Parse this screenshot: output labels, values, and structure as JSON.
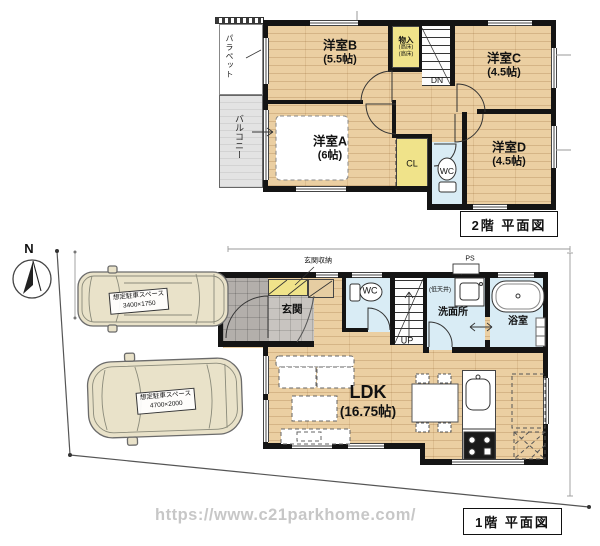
{
  "meta": {
    "watermark": "https://www.c21parkhome.com/"
  },
  "colors": {
    "wood_floor": "#ebcfa2",
    "wall": "#141414",
    "closet_yellow": "#f0e38a",
    "wet_area_blue": "#d9ecf5",
    "entrance_tile_gray": "#c8c4c0",
    "porch_gray": "#b3afab",
    "balcony_gray": "#e3e3e3",
    "car_body": "#e9e2c9"
  },
  "floor2": {
    "caption": "2階 平面図",
    "room_b": {
      "name": "洋室B",
      "size": "(5.5帖)"
    },
    "room_c": {
      "name": "洋室C",
      "size": "(4.5帖)"
    },
    "room_a": {
      "name": "洋室A",
      "size": "(6帖)"
    },
    "room_d": {
      "name": "洋室D",
      "size": "(4.5帖)"
    },
    "storage": {
      "name": "物入",
      "note1": "(高床)",
      "note2": "(高床)"
    },
    "closet": "CL",
    "toilet": "WC",
    "balcony": "バルコニー",
    "parapet": "パラペット",
    "stairs_down": "DN"
  },
  "floor1": {
    "caption": "1階 平面図",
    "ldk": {
      "name": "LDK",
      "size": "(16.75帖)"
    },
    "entrance": "玄関",
    "entrance_storage": "玄関収納",
    "toilet": "WC",
    "washroom": "洗面所",
    "bathroom": "浴室",
    "pipe_space": "PS",
    "low_ceiling": "(低天井)",
    "stairs_up": "UP",
    "north": "N",
    "parking_small": {
      "line1": "想定駐車スペース",
      "line2": "3400×1750"
    },
    "parking_large": {
      "line1": "想定駐車スペース",
      "line2": "4700×2000"
    }
  }
}
